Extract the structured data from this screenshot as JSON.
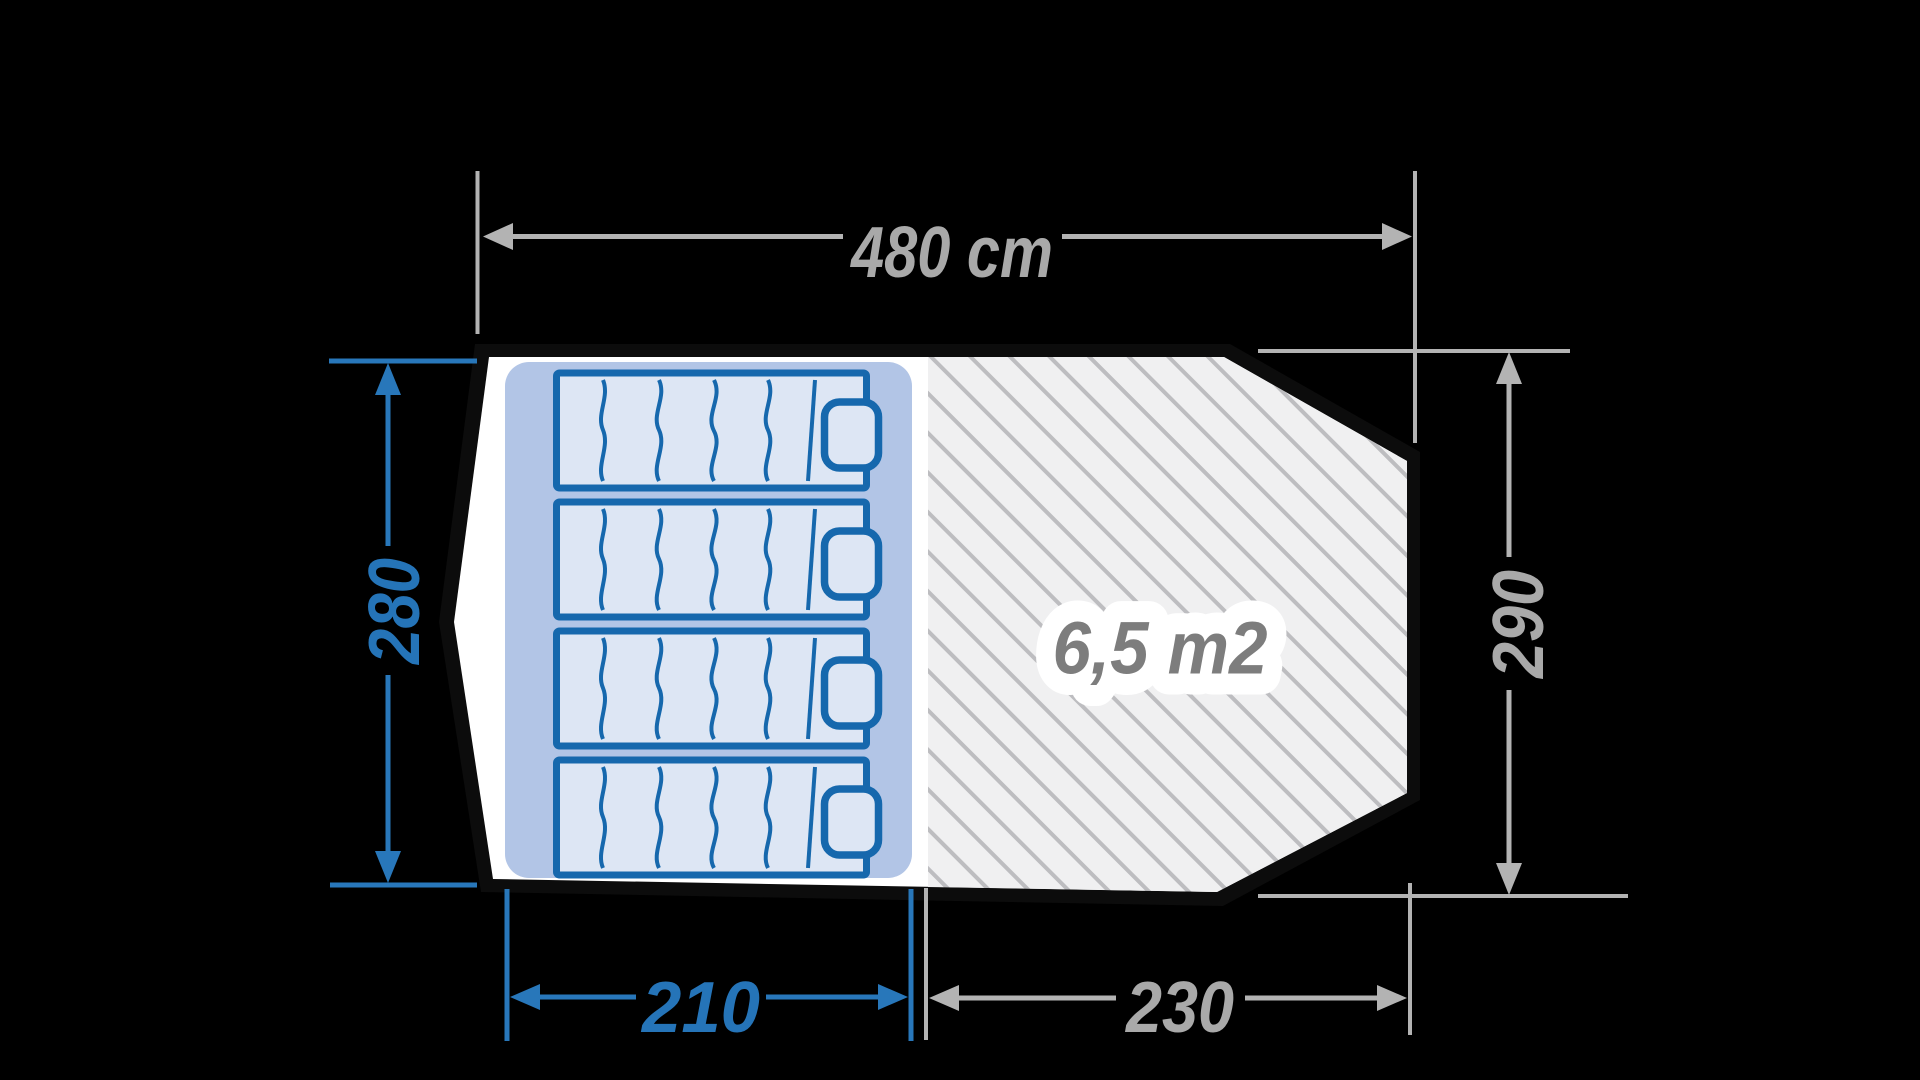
{
  "diagram": {
    "kind": "tent-floorplan",
    "background": "#000000"
  },
  "dimensions": {
    "total_width": {
      "label": "480 cm",
      "value_cm": 480,
      "color": "gray",
      "position": "top"
    },
    "left_depth": {
      "label": "280",
      "value_cm": 280,
      "color": "blue",
      "position": "left"
    },
    "right_depth": {
      "label": "290",
      "value_cm": 290,
      "color": "gray",
      "position": "right"
    },
    "sleeping_width": {
      "label": "210",
      "value_cm": 210,
      "color": "blue",
      "position": "bottom-left"
    },
    "living_width": {
      "label": "230",
      "value_cm": 230,
      "color": "gray",
      "position": "bottom-right"
    }
  },
  "sleeping_area": {
    "mattress_count": 4,
    "fill_color": "#b2c5e6",
    "mattress_fill": "#dde6f4",
    "mattress_border": "#1668ad"
  },
  "living_area": {
    "label": "6,5 m2",
    "area_m2": 6.5,
    "fill_color": "#f0f0f1",
    "hatch_color": "#bdbdc0",
    "label_color": "#7d7d7d"
  },
  "colors": {
    "background": "#000000",
    "tent_outline": "#0c0c0c",
    "tent_floor": "#ffffff",
    "dimension_blue": "#2574b8",
    "dimension_gray_line": "#b3b3b3",
    "dimension_gray_text": "#a9a9a9"
  }
}
